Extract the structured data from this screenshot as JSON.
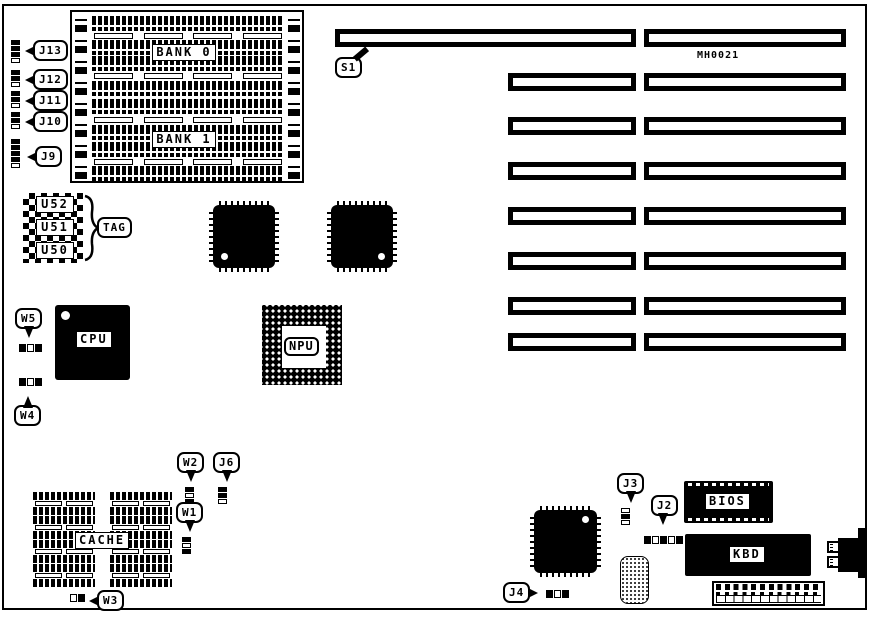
{
  "diagram": {
    "board_id": "MH0021",
    "memory": {
      "bank0": "BANK 0",
      "bank1": "BANK 1"
    },
    "chips": {
      "cpu": "CPU",
      "npu": "NPU",
      "cache": "CACHE",
      "bios": "BIOS",
      "kbd": "KBD",
      "u52": "U52",
      "u51": "U51",
      "u50": "U50"
    },
    "callouts": {
      "j13": "J13",
      "j12": "J12",
      "j11": "J11",
      "j10": "J10",
      "j9": "J9",
      "j6": "J6",
      "j4": "J4",
      "j3": "J3",
      "j2": "J2",
      "w5": "W5",
      "w4": "W4",
      "w3": "W3",
      "w2": "W2",
      "w1": "W1",
      "s1": "S1",
      "tag": "TAG"
    },
    "colors": {
      "ink": "#000000",
      "paper": "#ffffff"
    }
  }
}
